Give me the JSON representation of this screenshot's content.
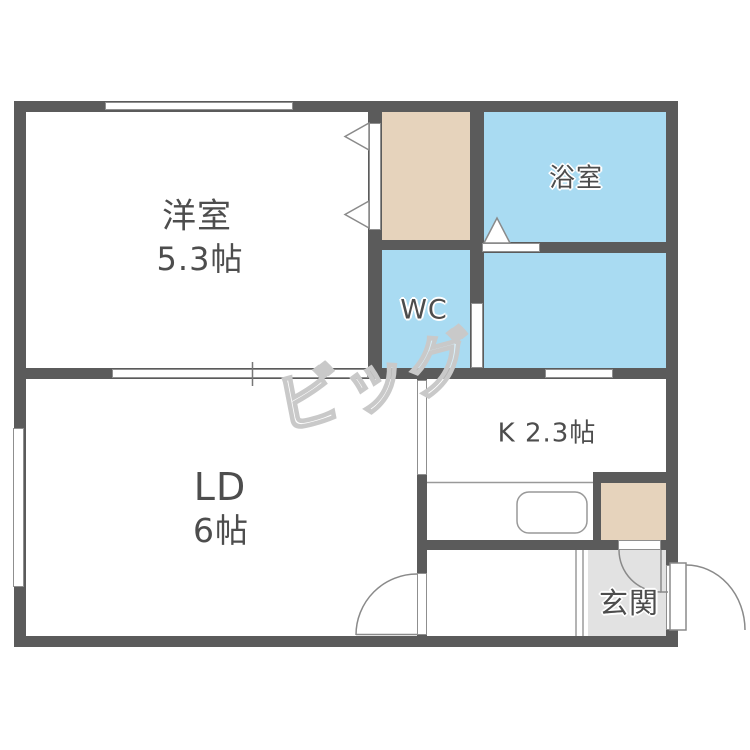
{
  "floorplan": {
    "rooms": {
      "western_room": {
        "name": "洋室",
        "size": "5.3帖"
      },
      "bathroom": {
        "name": "浴室"
      },
      "toilet": {
        "name": "WC"
      },
      "kitchen": {
        "name": "K 2.3帖"
      },
      "living_dining": {
        "name": "LD",
        "size": "6帖"
      },
      "entrance": {
        "name": "玄関"
      }
    },
    "watermark": {
      "text": "ビッグ"
    },
    "colors": {
      "wall": "#5b5b5b",
      "wet_area_fill": "#a9dbf2",
      "closet_fill": "#e6d3bc",
      "entrance_fill": "#e2e2e2",
      "label_text": "#4d4d4d",
      "symbol_line": "#8a8a8a",
      "watermark_outline": "#c9c9c9"
    }
  }
}
